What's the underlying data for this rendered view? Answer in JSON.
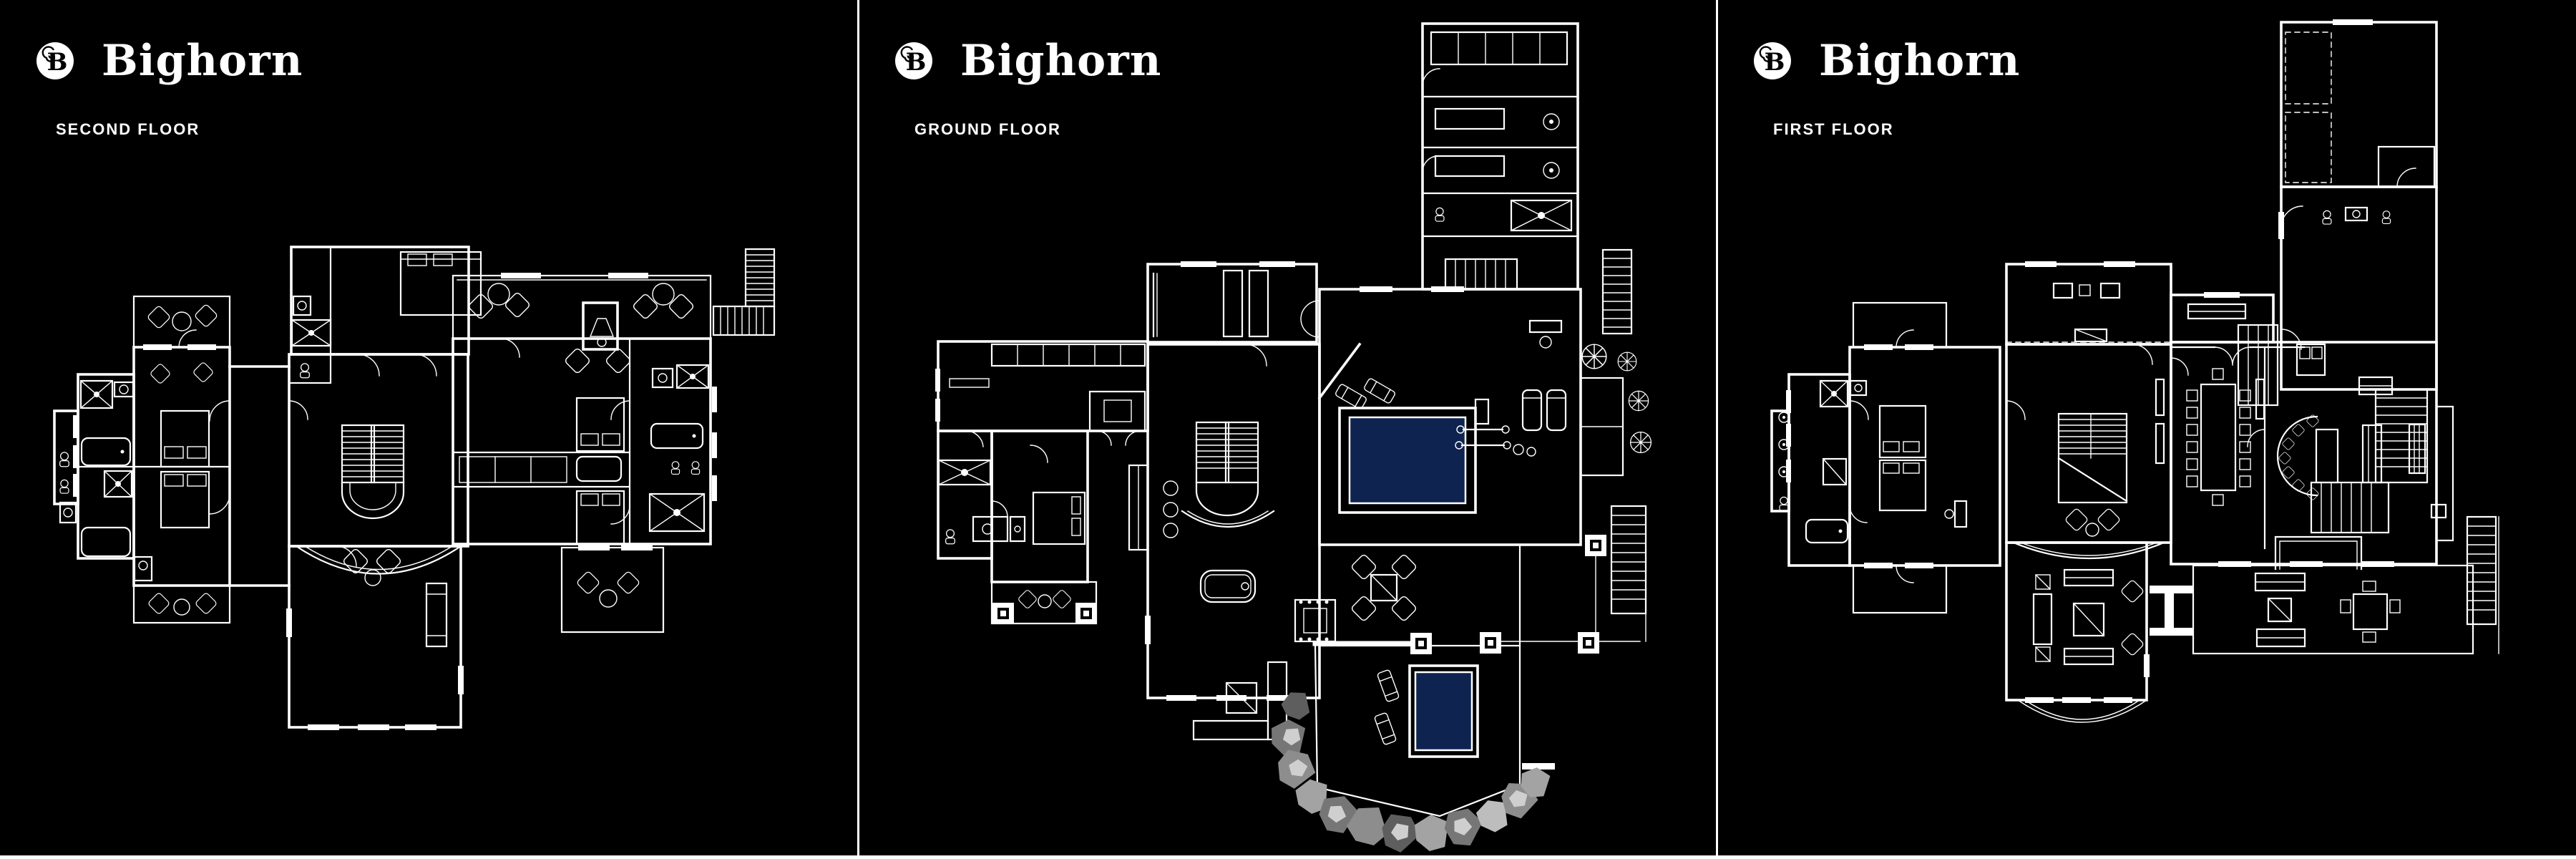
{
  "brand": {
    "wordmark": "Bighorn",
    "logo_icon": "bighorn-ram-horn-b-monogram"
  },
  "panels": [
    {
      "id": "second-floor",
      "label": "SECOND FLOOR"
    },
    {
      "id": "ground-floor",
      "label": "GROUND FLOOR"
    },
    {
      "id": "first-floor",
      "label": "FIRST FLOOR"
    }
  ],
  "colors": {
    "background": "#000000",
    "linework": "#ffffff",
    "divider": "#ffffff",
    "pool_water": "#0f2350",
    "boulder_grays": [
      "#5e5e5e",
      "#767676",
      "#8d8d8d",
      "#a3a3a3",
      "#bdbdbd"
    ],
    "boulder_highlight": "#cfcfcf"
  }
}
